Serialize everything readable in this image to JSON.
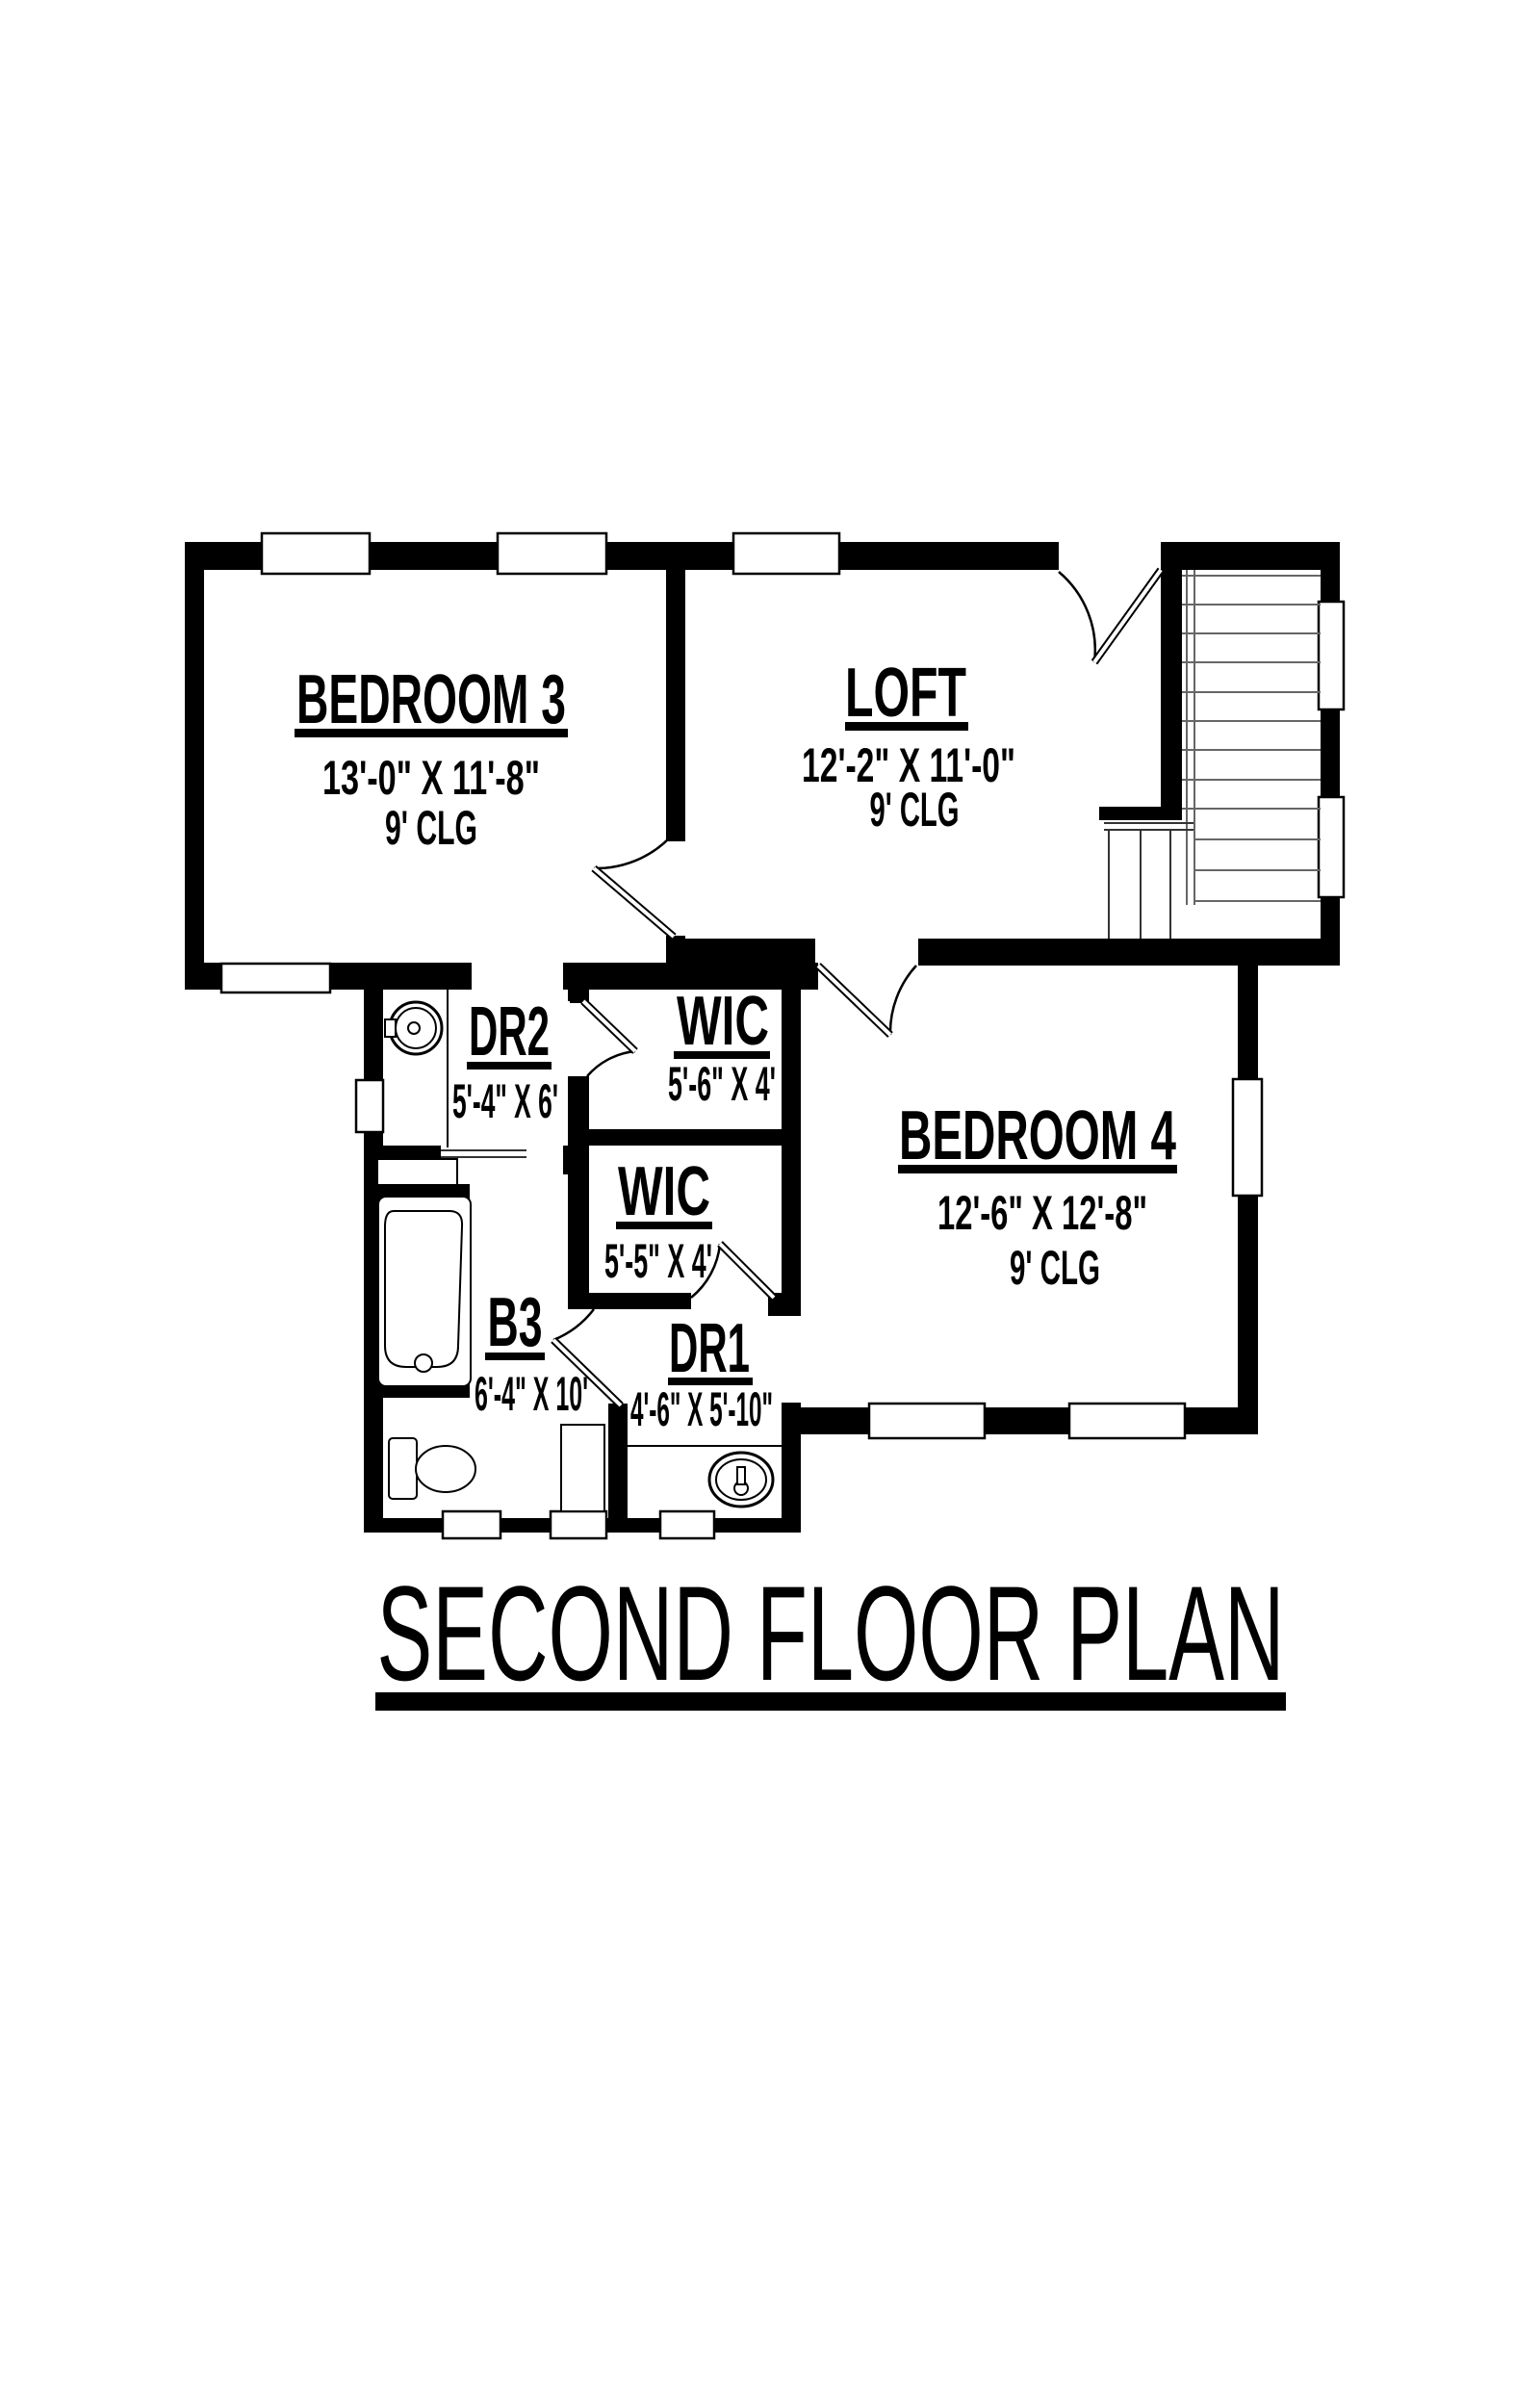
{
  "title": {
    "text": "SECOND FLOOR PLAN"
  },
  "rooms": {
    "bedroom3": {
      "name": "BEDROOM 3",
      "dims": "13'-0\" X 11'-8\"",
      "ceiling": "9' CLG"
    },
    "loft": {
      "name": "LOFT",
      "dims": "12'-2\" X 11'-0\"",
      "ceiling": "9' CLG"
    },
    "bedroom4": {
      "name": "BEDROOM 4",
      "dims": "12'-6\" X 12'-8\"",
      "ceiling": "9' CLG"
    },
    "wic1": {
      "name": "WIC",
      "dims": "5'-6\" X 4'"
    },
    "wic2": {
      "name": "WIC",
      "dims": "5'-5\" X 4'"
    },
    "dr2": {
      "name": "DR2",
      "dims": "5'-4\" X 6'"
    },
    "dr1": {
      "name": "DR1",
      "dims": "4'-6\" X 5'-10\""
    },
    "b3": {
      "name": "B3",
      "dims": "6'-4\" X 10'"
    }
  },
  "colors": {
    "walls": "#000000",
    "background": "#ffffff"
  }
}
